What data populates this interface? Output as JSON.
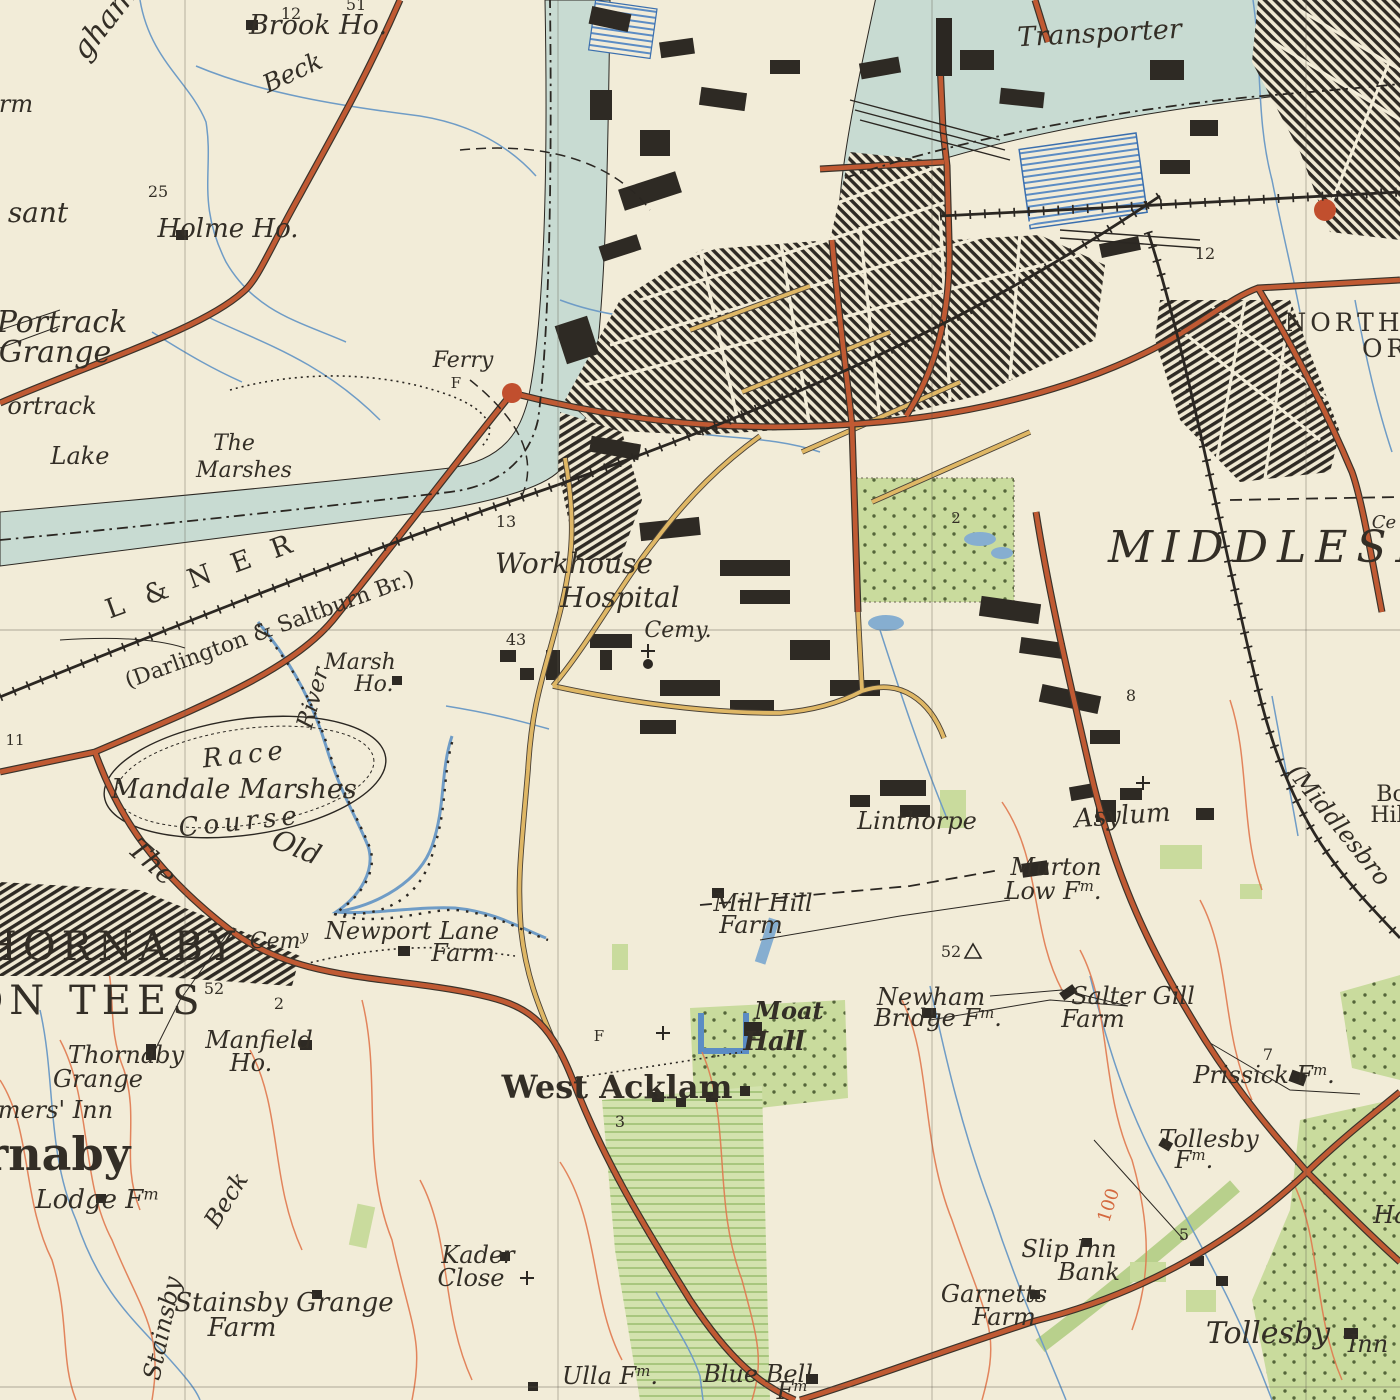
{
  "map": {
    "region": "Middlesbrough and Thornaby-on-Tees",
    "style": "vintage-ordnance-survey",
    "colors": {
      "paper": "#f2ecd8",
      "river_fill": "#c8dbd2",
      "water_line": "#6f9cc6",
      "dock_hatch": "#4f83bd",
      "road_red": "#c05a33",
      "road_yellow": "#dfb765",
      "railway": "#2b2722",
      "urban": "#2e2a24",
      "green": "#c9db9d",
      "contour": "#e0794f",
      "ink": "#332e26"
    }
  },
  "labels": [
    {
      "t": "Transporter",
      "x": 1100,
      "y": 42,
      "s": 27,
      "c": "it",
      "r": -3
    },
    {
      "t": "Brook Ho.",
      "x": 318,
      "y": 34,
      "s": 27,
      "c": "it"
    },
    {
      "t": "51",
      "x": 356,
      "y": 10,
      "s": 16,
      "c": "num"
    },
    {
      "t": "12",
      "x": 291,
      "y": 19,
      "s": 16,
      "c": "num"
    },
    {
      "t": "Beck",
      "x": 296,
      "y": 80,
      "s": 25,
      "c": "it",
      "r": -25
    },
    {
      "t": "gham",
      "x": 112,
      "y": 28,
      "s": 30,
      "c": "it",
      "r": -52
    },
    {
      "t": "rm",
      "x": 16,
      "y": 112,
      "s": 24,
      "c": "it"
    },
    {
      "t": "25",
      "x": 158,
      "y": 197,
      "s": 16,
      "c": "num"
    },
    {
      "t": "sant",
      "x": 38,
      "y": 222,
      "s": 28,
      "c": "it"
    },
    {
      "t": "Holme Ho.",
      "x": 228,
      "y": 237,
      "s": 26,
      "c": "it"
    },
    {
      "t": "Portrack",
      "x": 62,
      "y": 332,
      "s": 30,
      "c": "it"
    },
    {
      "t": "Grange",
      "x": 55,
      "y": 362,
      "s": 30,
      "c": "it"
    },
    {
      "t": "ortrack",
      "x": 52,
      "y": 414,
      "s": 24,
      "c": "it"
    },
    {
      "t": "Lake",
      "x": 80,
      "y": 464,
      "s": 24,
      "c": "it"
    },
    {
      "t": "The",
      "x": 234,
      "y": 450,
      "s": 22,
      "c": "it"
    },
    {
      "t": "Marshes",
      "x": 244,
      "y": 477,
      "s": 22,
      "c": "it"
    },
    {
      "t": "Ferry",
      "x": 463,
      "y": 367,
      "s": 22,
      "c": "it"
    },
    {
      "t": "F",
      "x": 456,
      "y": 388,
      "s": 15,
      "c": "num"
    },
    {
      "t": "13",
      "x": 506,
      "y": 527,
      "s": 16,
      "c": "num"
    },
    {
      "t": "L & N E R",
      "x": 205,
      "y": 584,
      "s": 27,
      "c": "rm",
      "r": -20,
      "sp": 7
    },
    {
      "t": "(Darlington & Saltburn Br.)",
      "x": 272,
      "y": 636,
      "s": 22,
      "c": "rm",
      "r": -20
    },
    {
      "t": "Marsh",
      "x": 360,
      "y": 669,
      "s": 22,
      "c": "it"
    },
    {
      "t": "Ho.",
      "x": 374,
      "y": 691,
      "s": 22,
      "c": "it"
    },
    {
      "t": "43",
      "x": 516,
      "y": 645,
      "s": 16,
      "c": "num"
    },
    {
      "t": "Workhouse",
      "x": 574,
      "y": 573,
      "s": 28,
      "c": "it"
    },
    {
      "t": "Hospital",
      "x": 620,
      "y": 607,
      "s": 28,
      "c": "it"
    },
    {
      "t": "Cemy.",
      "x": 678,
      "y": 637,
      "s": 22,
      "c": "it"
    },
    {
      "t": "2",
      "x": 956,
      "y": 523,
      "s": 15,
      "c": "num"
    },
    {
      "t": "MIDDLESBR",
      "x": 1108,
      "y": 562,
      "s": 44,
      "c": "big",
      "a": "start",
      "sp": 9
    },
    {
      "t": "Ce",
      "x": 1384,
      "y": 528,
      "s": 18,
      "c": "it"
    },
    {
      "t": "NORTH",
      "x": 1344,
      "y": 331,
      "s": 25,
      "c": "caps",
      "sp": 4
    },
    {
      "t": "ORM",
      "x": 1362,
      "y": 357,
      "s": 25,
      "c": "caps",
      "a": "start",
      "sp": 4
    },
    {
      "t": "12",
      "x": 1205,
      "y": 259,
      "s": 16,
      "c": "num"
    },
    {
      "t": "8",
      "x": 1131,
      "y": 701,
      "s": 16,
      "c": "num"
    },
    {
      "t": "Race",
      "x": 246,
      "y": 763,
      "s": 26,
      "c": "it",
      "sp": 5,
      "r": -6
    },
    {
      "t": "Mandale Marshes",
      "x": 234,
      "y": 798,
      "s": 27,
      "c": "it"
    },
    {
      "t": "Course",
      "x": 241,
      "y": 830,
      "s": 26,
      "c": "it",
      "sp": 5,
      "r": -6
    },
    {
      "t": "Old",
      "x": 293,
      "y": 856,
      "s": 28,
      "c": "it",
      "r": 22
    },
    {
      "t": "The",
      "x": 146,
      "y": 869,
      "s": 28,
      "c": "it",
      "r": 42
    },
    {
      "t": "River",
      "x": 320,
      "y": 700,
      "s": 23,
      "c": "it",
      "r": -74
    },
    {
      "t": "11",
      "x": 15,
      "y": 745,
      "s": 15,
      "c": "num"
    },
    {
      "t": "Linthorpe",
      "x": 917,
      "y": 829,
      "s": 24,
      "c": "it"
    },
    {
      "t": "Asylum",
      "x": 1123,
      "y": 824,
      "s": 26,
      "c": "it",
      "r": -4
    },
    {
      "t": "Murton",
      "x": 1056,
      "y": 875,
      "s": 24,
      "c": "it"
    },
    {
      "t": "Low F^m.",
      "x": 1053,
      "y": 899,
      "s": 24,
      "c": "it"
    },
    {
      "t": "52",
      "x": 951,
      "y": 957,
      "s": 16,
      "c": "num"
    },
    {
      "t": "(Middlesbro",
      "x": 1333,
      "y": 830,
      "s": 24,
      "c": "it",
      "r": 51
    },
    {
      "t": "Bo",
      "x": 1391,
      "y": 801,
      "s": 22,
      "c": "rm"
    },
    {
      "t": "Hil",
      "x": 1387,
      "y": 822,
      "s": 22,
      "c": "rm"
    },
    {
      "t": "THORNABY",
      "x": 95,
      "y": 960,
      "s": 40,
      "c": "caps",
      "sp": 6
    },
    {
      "t": "ON TEES",
      "x": 88,
      "y": 1014,
      "s": 40,
      "c": "caps",
      "sp": 6
    },
    {
      "t": "52",
      "x": 214,
      "y": 994,
      "s": 16,
      "c": "num"
    },
    {
      "t": "2",
      "x": 279,
      "y": 1009,
      "s": 16,
      "c": "num"
    },
    {
      "t": "Cem^y",
      "x": 279,
      "y": 948,
      "s": 22,
      "c": "it"
    },
    {
      "t": "Newport Lane",
      "x": 412,
      "y": 939,
      "s": 24,
      "c": "it"
    },
    {
      "t": "Farm",
      "x": 463,
      "y": 961,
      "s": 24,
      "c": "it"
    },
    {
      "t": "Manfield",
      "x": 259,
      "y": 1048,
      "s": 24,
      "c": "it"
    },
    {
      "t": "Ho.",
      "x": 251,
      "y": 1071,
      "s": 24,
      "c": "it"
    },
    {
      "t": "Thornaby",
      "x": 126,
      "y": 1063,
      "s": 24,
      "c": "it"
    },
    {
      "t": "Grange",
      "x": 98,
      "y": 1087,
      "s": 24,
      "c": "it"
    },
    {
      "t": "Farmers' Inn",
      "x": 35,
      "y": 1118,
      "s": 24,
      "c": "it"
    },
    {
      "t": "Thornaby",
      "x": 8,
      "y": 1170,
      "s": 46,
      "c": "rm",
      "b": 1
    },
    {
      "t": "Lodge F^m",
      "x": 97,
      "y": 1208,
      "s": 26,
      "c": "it"
    },
    {
      "t": "Stainsby",
      "x": 170,
      "y": 1330,
      "s": 24,
      "c": "it",
      "r": -78
    },
    {
      "t": "Beck",
      "x": 233,
      "y": 1204,
      "s": 24,
      "c": "it",
      "r": -58
    },
    {
      "t": "Stainsby Grange",
      "x": 284,
      "y": 1311,
      "s": 26,
      "c": "it"
    },
    {
      "t": "Farm",
      "x": 242,
      "y": 1336,
      "s": 26,
      "c": "it"
    },
    {
      "t": "Kader",
      "x": 478,
      "y": 1263,
      "s": 24,
      "c": "it"
    },
    {
      "t": "Close",
      "x": 471,
      "y": 1286,
      "s": 24,
      "c": "it"
    },
    {
      "t": "Ulla F^m.",
      "x": 610,
      "y": 1384,
      "s": 24,
      "c": "it"
    },
    {
      "t": "Blue Bell",
      "x": 758,
      "y": 1382,
      "s": 24,
      "c": "it"
    },
    {
      "t": "F^m",
      "x": 792,
      "y": 1399,
      "s": 24,
      "c": "it"
    },
    {
      "t": "Garnetts",
      "x": 994,
      "y": 1302,
      "s": 24,
      "c": "it"
    },
    {
      "t": "Farm",
      "x": 1004,
      "y": 1325,
      "s": 24,
      "c": "it"
    },
    {
      "t": "Slip Inn",
      "x": 1069,
      "y": 1257,
      "s": 24,
      "c": "it"
    },
    {
      "t": "Bank",
      "x": 1089,
      "y": 1280,
      "s": 24,
      "c": "it"
    },
    {
      "t": "100",
      "x": 1114,
      "y": 1207,
      "s": 18,
      "c": "cont",
      "r": -72
    },
    {
      "t": "5",
      "x": 1184,
      "y": 1240,
      "s": 16,
      "c": "num"
    },
    {
      "t": "Tollesby",
      "x": 1209,
      "y": 1147,
      "s": 24,
      "c": "it"
    },
    {
      "t": "F^m.",
      "x": 1194,
      "y": 1168,
      "s": 24,
      "c": "it"
    },
    {
      "t": "Tollesby",
      "x": 1268,
      "y": 1343,
      "s": 30,
      "c": "it"
    },
    {
      "t": "Inn",
      "x": 1368,
      "y": 1352,
      "s": 24,
      "c": "it"
    },
    {
      "t": "Ha",
      "x": 1391,
      "y": 1223,
      "s": 24,
      "c": "it"
    },
    {
      "t": "Prissick F^m.",
      "x": 1264,
      "y": 1083,
      "s": 24,
      "c": "it"
    },
    {
      "t": "7",
      "x": 1268,
      "y": 1060,
      "s": 16,
      "c": "num"
    },
    {
      "t": "Salter Gill",
      "x": 1133,
      "y": 1004,
      "s": 24,
      "c": "it"
    },
    {
      "t": "Farm",
      "x": 1093,
      "y": 1027,
      "s": 24,
      "c": "it"
    },
    {
      "t": "Newham",
      "x": 931,
      "y": 1005,
      "s": 24,
      "c": "it"
    },
    {
      "t": "Bridge F^m.",
      "x": 938,
      "y": 1026,
      "s": 24,
      "c": "it"
    },
    {
      "t": "Moat",
      "x": 789,
      "y": 1019,
      "s": 24,
      "c": "it",
      "b": 1
    },
    {
      "t": "Hall",
      "x": 774,
      "y": 1050,
      "s": 26,
      "c": "it",
      "b": 1
    },
    {
      "t": "West Acklam",
      "x": 617,
      "y": 1098,
      "s": 32,
      "c": "rm",
      "b": 1
    },
    {
      "t": "3",
      "x": 620,
      "y": 1127,
      "s": 16,
      "c": "num"
    },
    {
      "t": "Mill Hill",
      "x": 763,
      "y": 911,
      "s": 24,
      "c": "it"
    },
    {
      "t": "Farm",
      "x": 751,
      "y": 933,
      "s": 24,
      "c": "it"
    },
    {
      "t": "F",
      "x": 599,
      "y": 1041,
      "s": 15,
      "c": "num"
    }
  ]
}
